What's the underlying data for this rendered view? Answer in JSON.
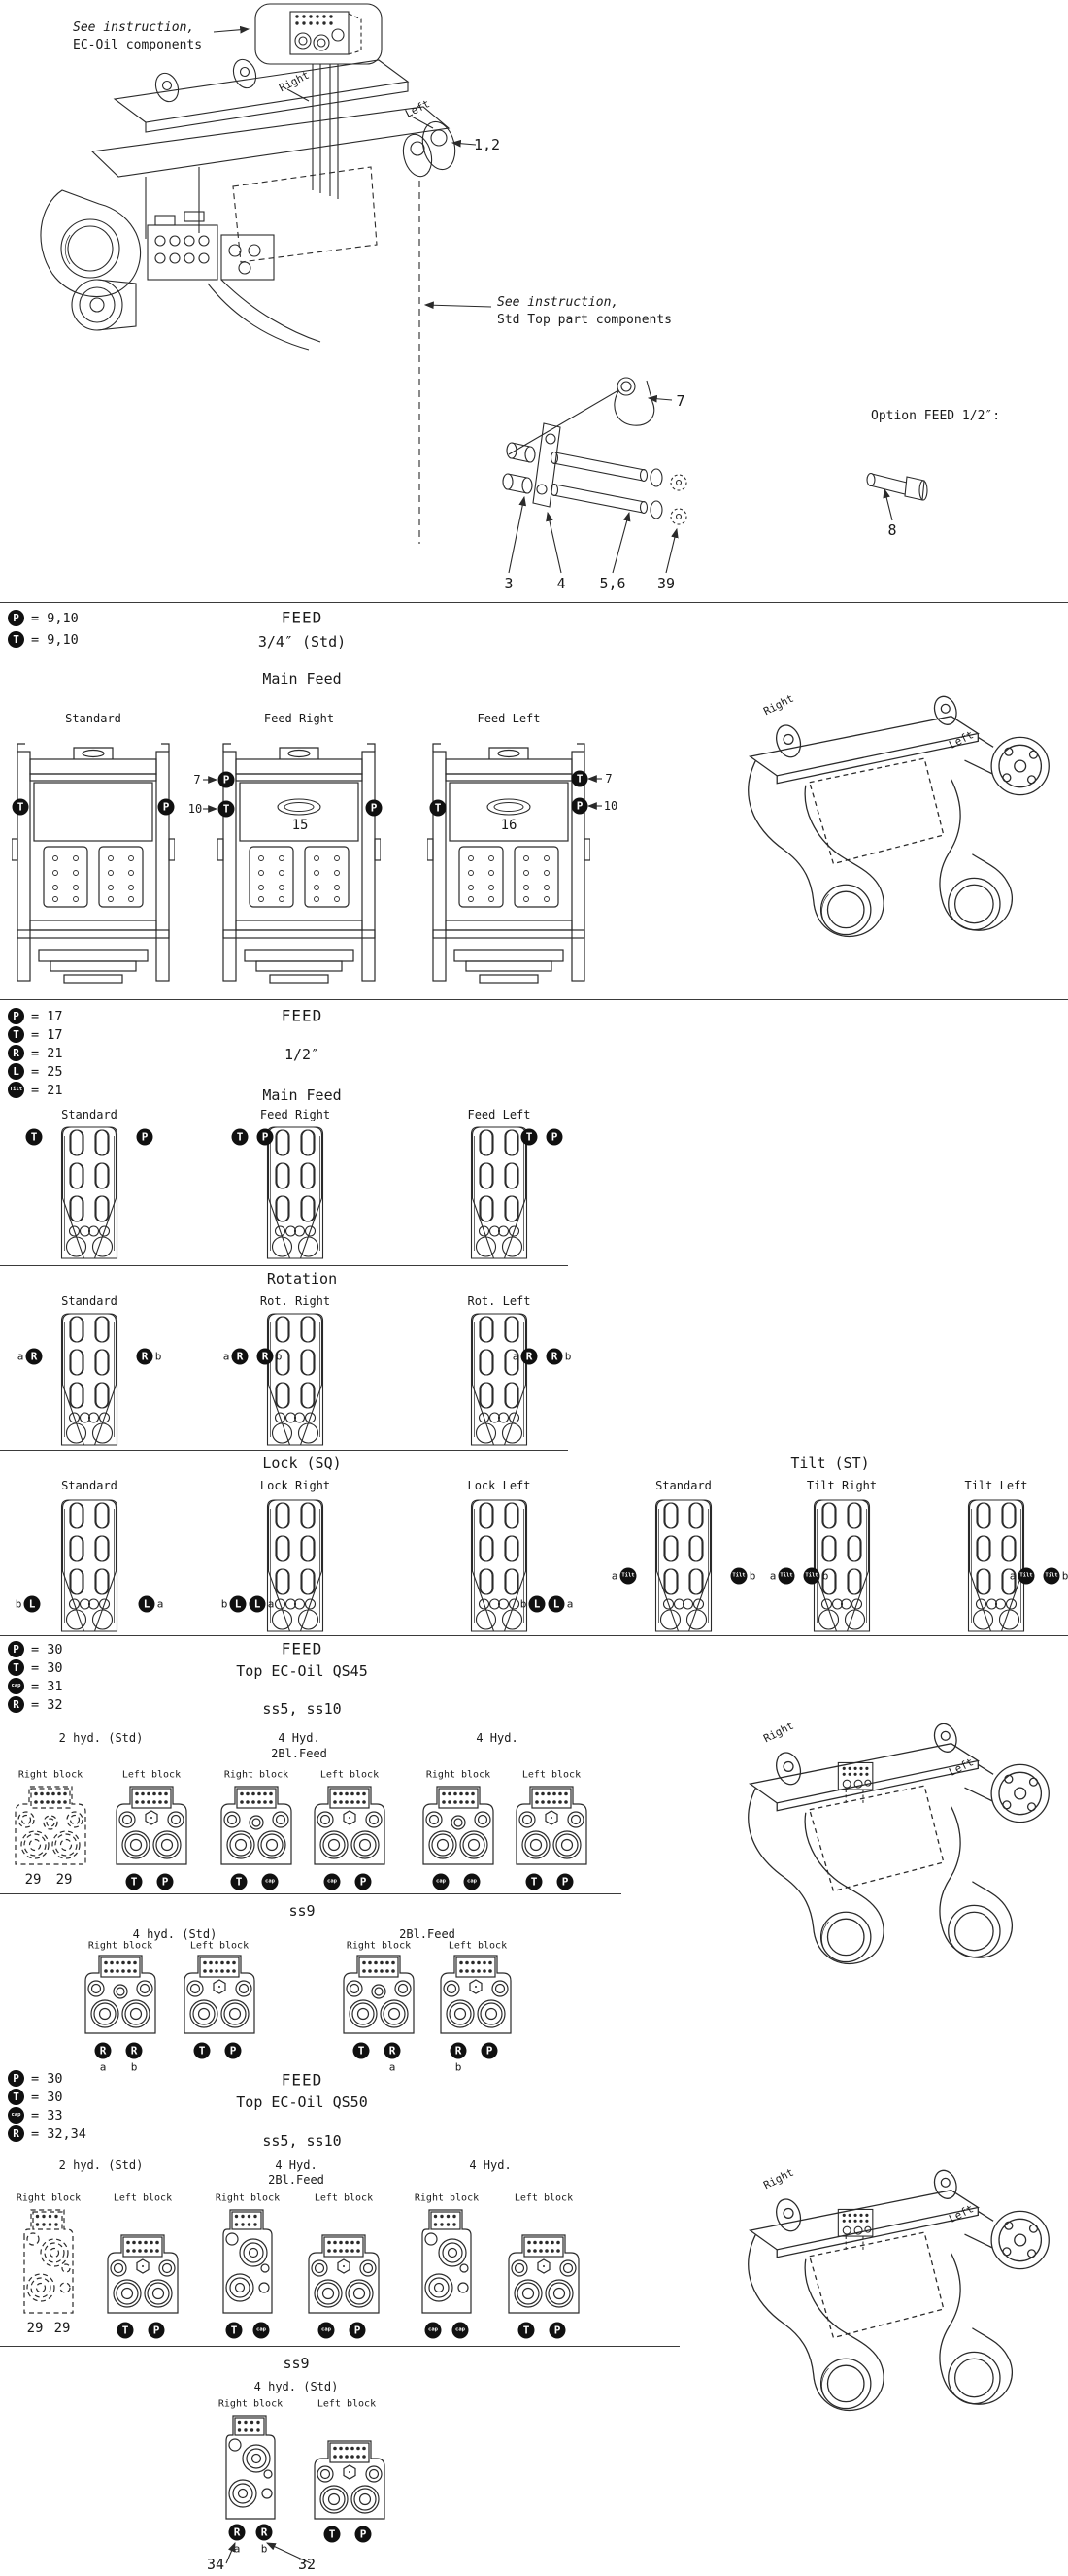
{
  "colors": {
    "ink": "#2a2a2a",
    "paper": "#ffffff",
    "badge_bg": "#101010"
  },
  "badges": {
    "P": "P",
    "T": "T",
    "R": "R",
    "L": "L",
    "tilt": "Tilt",
    "cap": "cap"
  },
  "letters": {
    "a": "a",
    "b": "b"
  },
  "view": {
    "right": "Right",
    "left": "Left"
  },
  "top": {
    "ec_note_1": "See instruction,",
    "ec_note_2": "EC-Oil components",
    "std_note_1": "See instruction,",
    "std_note_2": "Std Top part components",
    "part_1_2": "1,2",
    "part_7": "7",
    "part_3": "3",
    "part_4": "4",
    "part_5_6": "5,6",
    "part_39": "39",
    "option_title": "Option FEED 1/2″:",
    "part_8": "8"
  },
  "feed34": {
    "legend": [
      {
        "v": "= 9,10"
      },
      {
        "v": "= 9,10"
      }
    ],
    "heading": "FEED",
    "size": "3/4″ (Std)",
    "group": "Main Feed",
    "cfg": [
      {
        "t": "Standard"
      },
      {
        "t": "Feed Right",
        "n": "15"
      },
      {
        "t": "Feed Left",
        "n": "16"
      }
    ],
    "ref_7": "7",
    "ref_10": "10"
  },
  "feed12": {
    "legend": [
      {
        "v": "= 17"
      },
      {
        "v": "= 17"
      },
      {
        "v": "= 21"
      },
      {
        "v": "= 25"
      },
      {
        "v": "= 21"
      }
    ],
    "heading": "FEED",
    "size": "1/2″",
    "main": {
      "title": "Main Feed",
      "cfg": [
        "Standard",
        "Feed Right",
        "Feed Left"
      ]
    },
    "rotation": {
      "title": "Rotation",
      "cfg": [
        "Standard",
        "Rot. Right",
        "Rot. Left"
      ]
    },
    "lock": {
      "title": "Lock (SQ)",
      "cfg": [
        "Standard",
        "Lock Right",
        "Lock Left"
      ]
    },
    "tilt": {
      "title": "Tilt (ST)",
      "cfg": [
        "Standard",
        "Tilt Right",
        "Tilt Left"
      ]
    }
  },
  "qs45": {
    "legend": [
      {
        "v": "= 30"
      },
      {
        "v": "= 30"
      },
      {
        "v": "= 31"
      },
      {
        "v": "= 32"
      }
    ],
    "heading": "FEED",
    "model": "Top EC-Oil QS45",
    "sizes": "ss5, ss10",
    "right_block": "Right block",
    "left_block": "Left block",
    "n29": "29",
    "cfg": [
      {
        "t": "2 hyd. (Std)"
      },
      {
        "t": "4 Hyd.",
        "t2": "2Bl.Feed"
      },
      {
        "t": "4 Hyd."
      }
    ],
    "ss9": {
      "title": "ss9",
      "cfg": [
        {
          "t": "4 hyd. (Std)"
        },
        {
          "t": "2Bl.Feed"
        }
      ]
    }
  },
  "qs50": {
    "legend": [
      {
        "v": "= 30"
      },
      {
        "v": "= 30"
      },
      {
        "v": "= 33"
      },
      {
        "v": "= 32,34"
      }
    ],
    "heading": "FEED",
    "model": "Top EC-Oil QS50",
    "sizes": "ss5, ss10",
    "right_block": "Right block",
    "left_block": "Left block",
    "n29": "29",
    "cfg": [
      {
        "t": "2 hyd. (Std)"
      },
      {
        "t": "4 Hyd.",
        "t2": "2Bl.Feed"
      },
      {
        "t": "4 Hyd."
      }
    ],
    "ss9": {
      "title": "ss9",
      "cfg": [
        {
          "t": "4 hyd. (Std)"
        }
      ],
      "part_34": "34",
      "part_32": "32"
    }
  }
}
